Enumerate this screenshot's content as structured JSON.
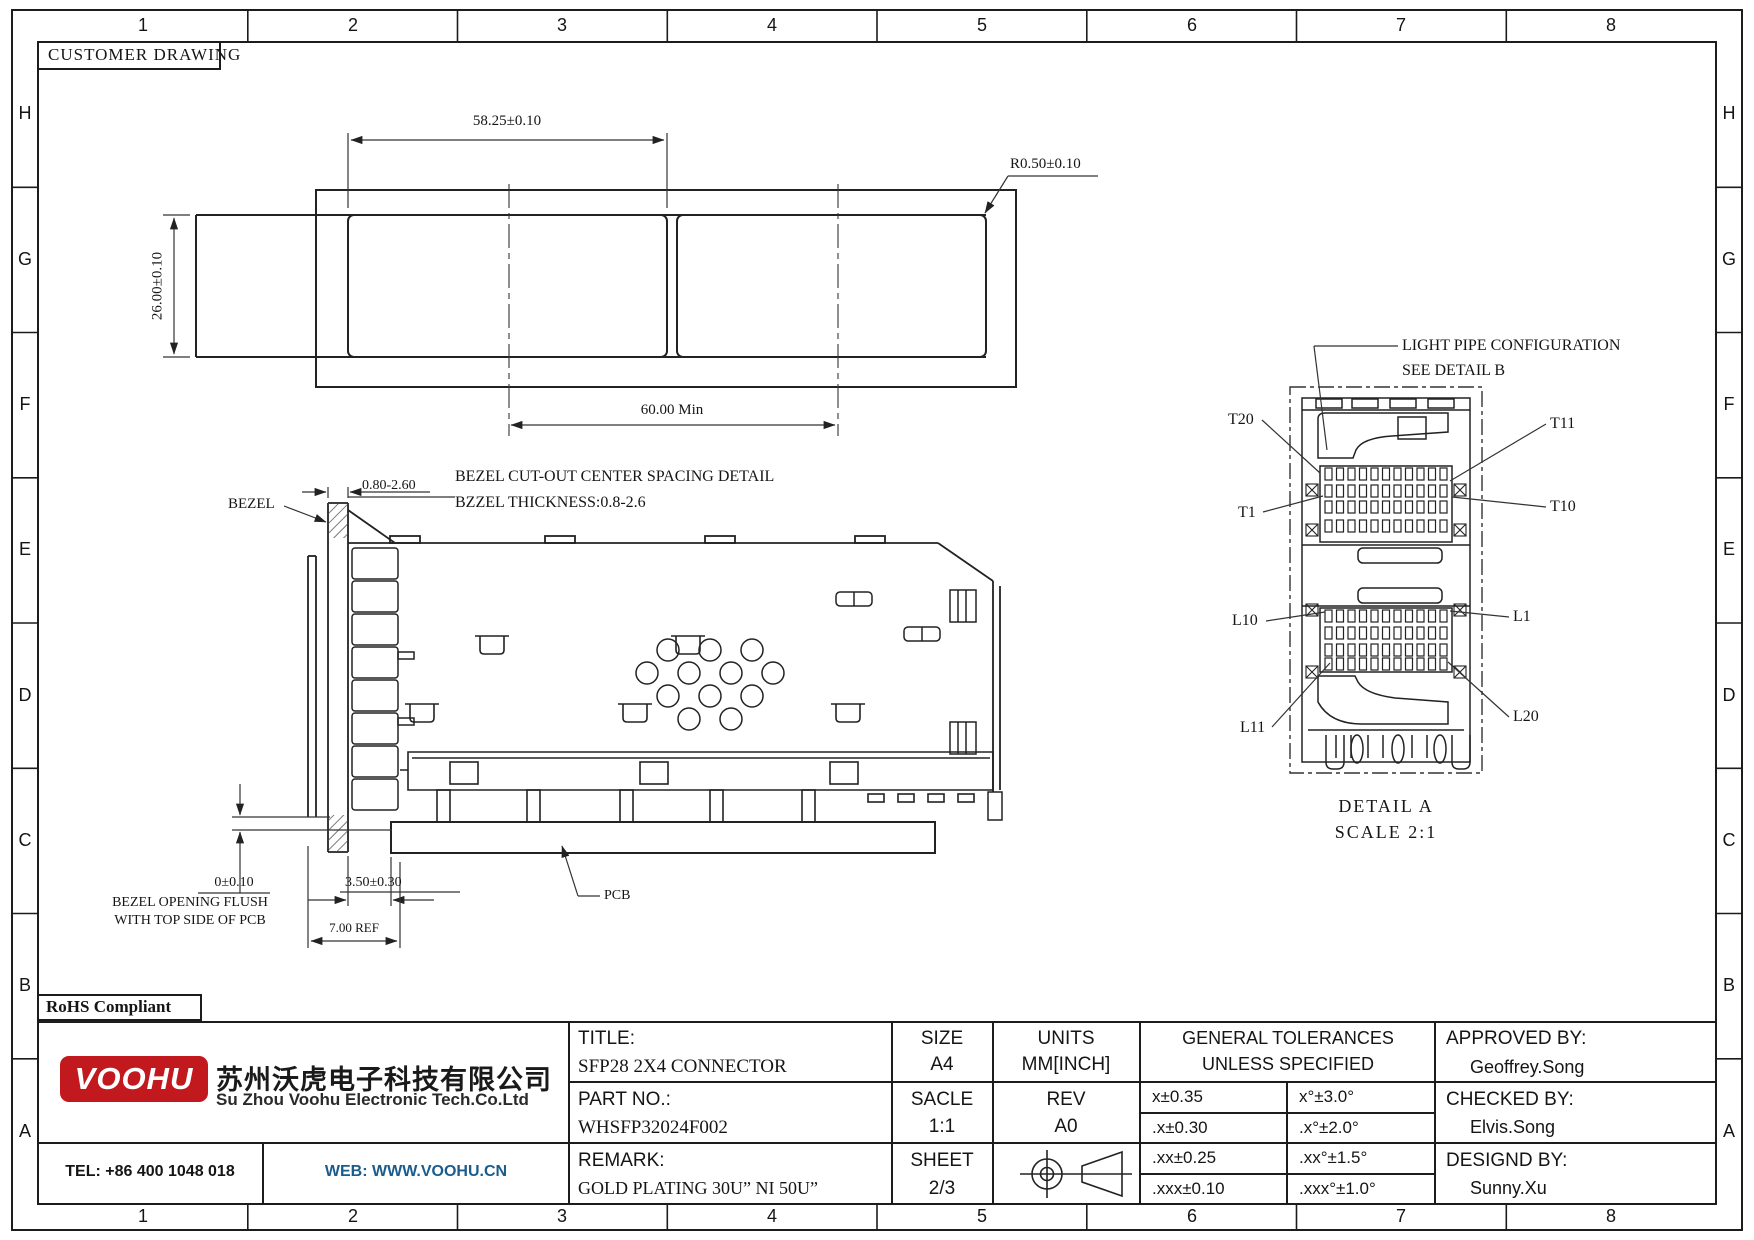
{
  "frame": {
    "customer_drawing": "CUSTOMER DRAWING",
    "rohs": "RoHS Compliant",
    "grid_cols": [
      "1",
      "2",
      "3",
      "4",
      "5",
      "6",
      "7",
      "8"
    ],
    "grid_rows": [
      "H",
      "G",
      "F",
      "E",
      "D",
      "C",
      "B",
      "A"
    ]
  },
  "top_view": {
    "dim_width": "58.25±0.10",
    "dim_corner_radius": "R0.50±0.10",
    "dim_height": "26.00±0.10",
    "dim_center_spacing": "60.00 Min",
    "caption_line1": "BEZEL CUT-OUT CENTER SPACING DETAIL",
    "caption_line2": "BZZEL THICKNESS:0.8-2.6"
  },
  "side_view": {
    "bezel_label": "BEZEL",
    "dim_bezel_thickness": "0.80-2.60",
    "dim_flush": "0±0.10",
    "flush_note_line1": "BEZEL OPENING FLUSH",
    "flush_note_line2": "WITH TOP SIDE OF PCB",
    "dim_pcb_setback": "3.50±0.30",
    "dim_ref": "7.00 REF",
    "pcb_label": "PCB"
  },
  "detail_a": {
    "light_pipe_note_line1": "LIGHT PIPE CONFIGURATION",
    "light_pipe_note_line2": "SEE DETAIL B",
    "pin_labels": {
      "t20": "T20",
      "t11": "T11",
      "t1": "T1",
      "t10": "T10",
      "l10": "L10",
      "l1": "L1",
      "l11": "L11",
      "l20": "L20"
    },
    "title": "DETAIL A",
    "scale": "SCALE 2:1"
  },
  "title_block": {
    "title_label": "TITLE:",
    "title_value": "SFP28 2X4 CONNECTOR",
    "size_label": "SIZE",
    "size_value": "A4",
    "units_label": "UNITS",
    "units_value": "MM[INCH]",
    "part_no_label": "PART NO.:",
    "part_no_value": "WHSFP32024F002",
    "scale_label": "SACLE",
    "scale_value": "1:1",
    "rev_label": "REV",
    "rev_value": "A0",
    "remark_label": "REMARK:",
    "remark_value": "GOLD PLATING 30U”  NI 50U”",
    "sheet_label": "SHEET",
    "sheet_value": "2/3",
    "tol_header_line1": "GENERAL TOLERANCES",
    "tol_header_line2": "UNLESS SPECIFIED",
    "tolerances": [
      [
        "x±0.35",
        "x°±3.0°"
      ],
      [
        ".x±0.30",
        ".x°±2.0°"
      ],
      [
        ".xx±0.25",
        ".xx°±1.5°"
      ],
      [
        ".xxx±0.10",
        ".xxx°±1.0°"
      ]
    ],
    "approved_label": "APPROVED BY:",
    "approved_value": "Geoffrey.Song",
    "checked_label": "CHECKED BY:",
    "checked_value": "Elvis.Song",
    "designed_label": "DESIGND BY:",
    "designed_value": "Sunny.Xu"
  },
  "company": {
    "logo_text": "VOOHU",
    "name_cn": "苏州沃虎电子科技有限公司",
    "name_en": "Su Zhou Voohu Electronic Tech.Co.Ltd",
    "tel": "TEL: +86 400 1048 018",
    "web": "WEB: WWW.VOOHU.CN",
    "brand_red": "#c2191f",
    "web_blue": "#1a5c8e"
  }
}
